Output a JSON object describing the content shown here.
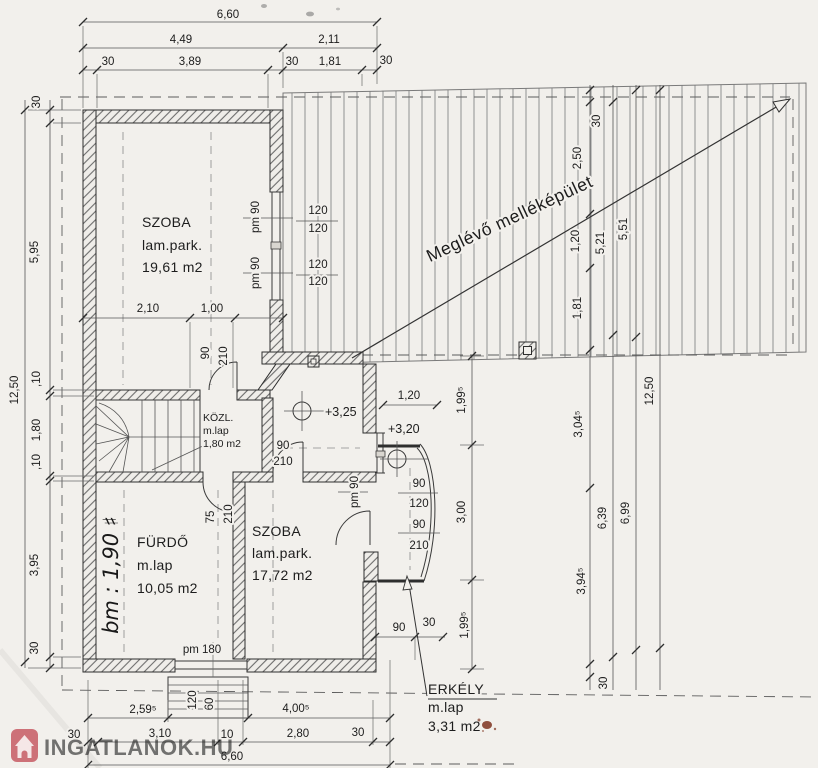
{
  "drawing": {
    "rooms": [
      {
        "name": "SZOBA",
        "finish": "lam.park.",
        "area": "19,61 m2"
      },
      {
        "name": "KÖZL.",
        "finish": "m.lap",
        "area": "1,80 m2"
      },
      {
        "name": "FÜRDŐ",
        "finish": "m.lap",
        "area": "10,05 m2"
      },
      {
        "name": "SZOBA",
        "finish": "lam.park.",
        "area": "17,72 m2"
      },
      {
        "name": "ERKÉLY",
        "finish": "m.lap",
        "area": "3,31 m2"
      }
    ],
    "outbuilding_label": "Meglévő melléképület",
    "levels": {
      "upper": "+3,25",
      "lower": "+3,20"
    },
    "handwritten_note": "bm : 1,90 ♯",
    "dims": {
      "top": [
        "6,60",
        "4,49",
        "2,11",
        "30",
        "3,89",
        "30",
        "1,81",
        "30"
      ],
      "left": [
        "30",
        "5,95",
        ",10",
        "1,80",
        ",10",
        "3,95",
        "30",
        "12,50"
      ],
      "right": [
        "30",
        "2,50",
        "1,20",
        "1,81",
        "5,21",
        "5,51",
        "3,04⁵",
        "6,39",
        "6,99",
        "3,94⁵",
        "12,50",
        "30"
      ],
      "bottom": [
        "2,59⁵",
        "4,00⁵",
        "30",
        "3,10",
        "10",
        "2,80",
        "30",
        "6,60"
      ],
      "interior": [
        "2,10",
        "1,00",
        "1,20",
        "1,99⁵",
        "3,00",
        "1,99⁵",
        "90",
        "30"
      ],
      "openings": {
        "door_kozl": [
          "90",
          "210"
        ],
        "door_szoba2": [
          "90",
          "210"
        ],
        "door_furdo": [
          "75",
          "210"
        ],
        "win_szoba1": [
          "pm 90",
          "pm 90"
        ],
        "win_120": [
          "120",
          "120",
          "120",
          "120"
        ],
        "win_erkely": [
          "90",
          "120",
          "90",
          "210"
        ],
        "win_erkely_pm": "pm 90",
        "win_furdo": "pm 180",
        "steps": [
          "120",
          "60"
        ]
      }
    }
  },
  "watermark": {
    "text": "INGATLANOK.HU",
    "color": "#bf4b55"
  }
}
